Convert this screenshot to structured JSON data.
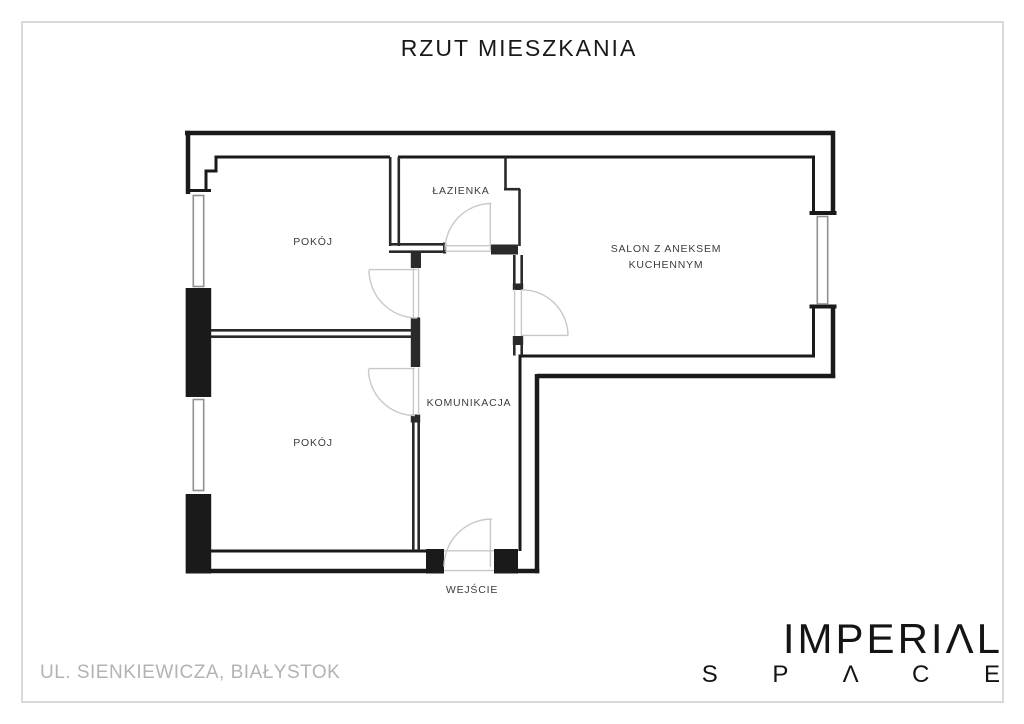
{
  "title": "RZUT MIESZKANIA",
  "rooms": [
    {
      "id": "pokoj-top",
      "label": "POKÓJ"
    },
    {
      "id": "lazienka",
      "label": "ŁAZIENKA"
    },
    {
      "id": "salon",
      "label": "SALON Z ANEKSEM",
      "label2": "KUCHENNYM"
    },
    {
      "id": "komunikacja",
      "label": "KOMUNIKACJA"
    },
    {
      "id": "pokoj-bottom",
      "label": "POKÓJ"
    }
  ],
  "entrance_label": "WEJŚCIE",
  "address": "UL. SIENKIEWICZA, BIAŁYSTOK",
  "brand": {
    "line1": "IMPERIΛL",
    "line2": "S P Λ C E"
  },
  "colors": {
    "wall": "#1a1a1a",
    "partition": "#2a2a2a",
    "door_arc": "#c8c8c8",
    "window": "#909090",
    "frame_border": "#d9d9d9",
    "address_text": "#b3b3b3"
  }
}
